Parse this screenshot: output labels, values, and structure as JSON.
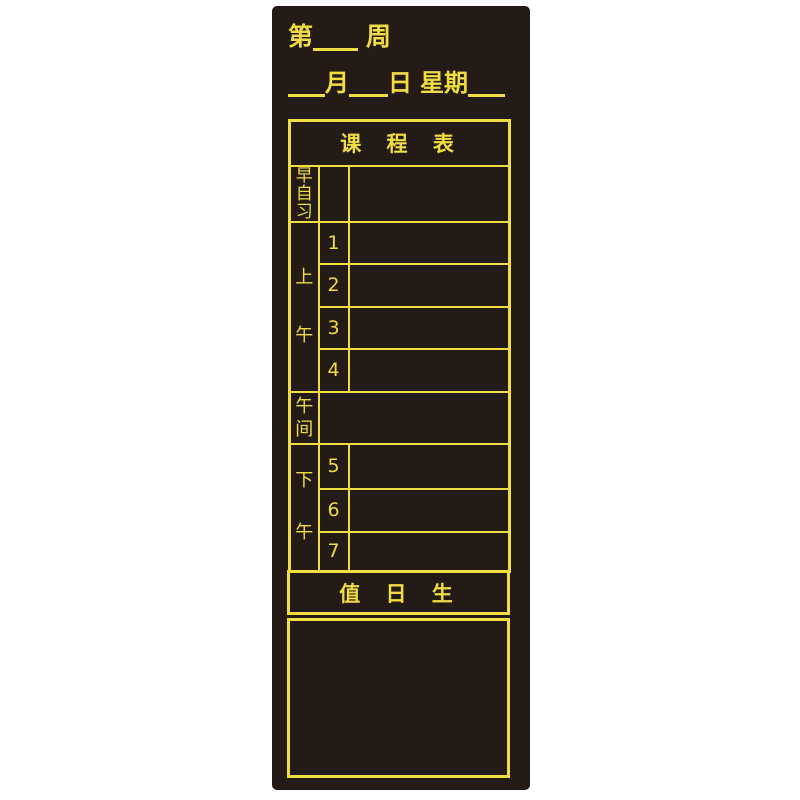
{
  "colors": {
    "page_bg": "#ffffff",
    "board_bg": "#251b16",
    "accent_yellow": "#efdd41"
  },
  "title_area": {
    "week_line": {
      "prefix": "第",
      "suffix": "周"
    },
    "date_line": {
      "month": "月",
      "day": "日",
      "weekday": "星期"
    }
  },
  "schedule": {
    "title": "课 程 表",
    "sections": [
      {
        "id": "morning-self-study",
        "label": "早自习",
        "rows": [
          {
            "period": ""
          }
        ]
      },
      {
        "id": "morning",
        "label": "上午",
        "rows": [
          {
            "period": "1"
          },
          {
            "period": "2"
          },
          {
            "period": "3"
          },
          {
            "period": "4"
          }
        ]
      },
      {
        "id": "noon",
        "label": "午间",
        "rows": [
          {
            "period": ""
          }
        ]
      },
      {
        "id": "afternoon",
        "label": "下午",
        "rows": [
          {
            "period": "5"
          },
          {
            "period": "6"
          },
          {
            "period": "7"
          }
        ]
      }
    ]
  },
  "duty": {
    "title": "值 日 生"
  }
}
